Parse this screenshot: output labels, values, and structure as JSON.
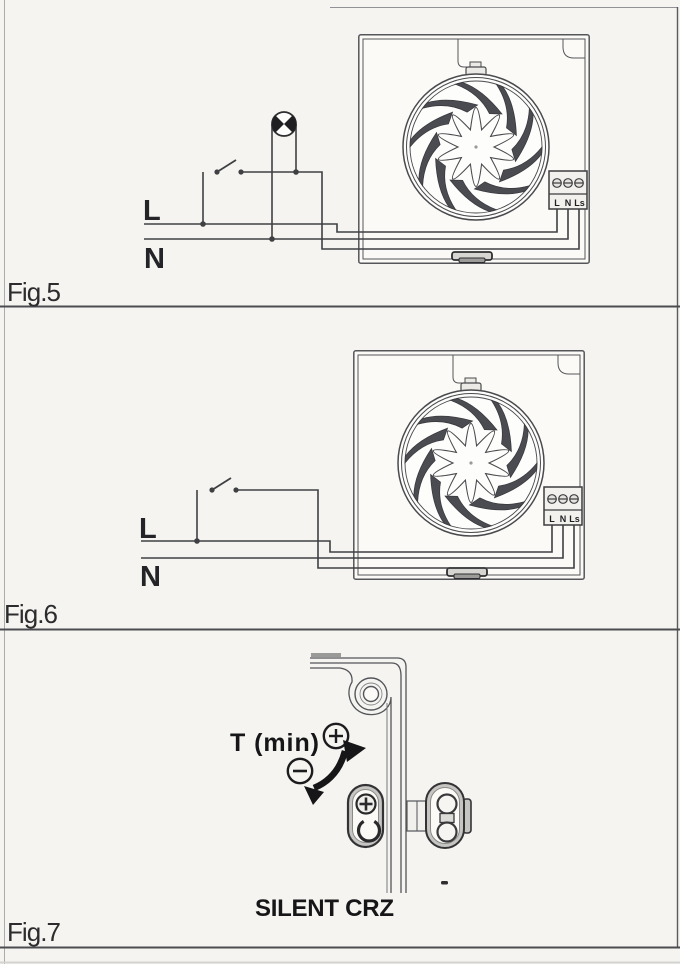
{
  "page": {
    "background": "#f5f4f0",
    "diagram_line_color": "#3f4043",
    "text_color": "#232326"
  },
  "figures": [
    {
      "label": "Fig.5",
      "wire_labels": {
        "live": "L",
        "neutral": "N"
      },
      "terminal_labels": [
        "L",
        "N",
        "Ls"
      ]
    },
    {
      "label": "Fig.6",
      "wire_labels": {
        "live": "L",
        "neutral": "N"
      },
      "terminal_labels": [
        "L",
        "N",
        "Ls"
      ]
    },
    {
      "label": "Fig.7",
      "timer_label": "T (min)",
      "plus_symbol": "+",
      "minus_symbol": "−",
      "model_name": "SILENT CRZ"
    }
  ]
}
